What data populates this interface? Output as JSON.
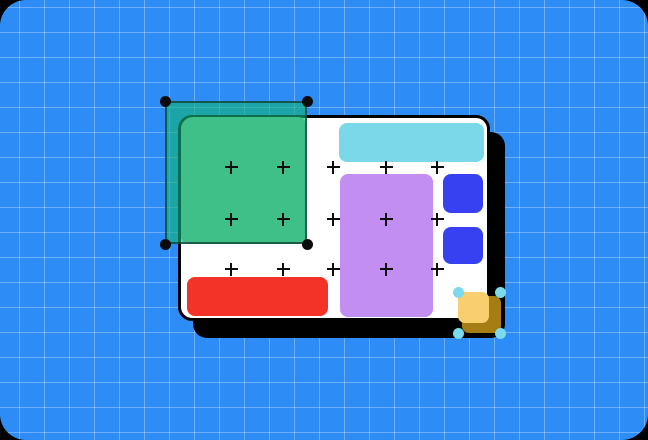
{
  "scene": {
    "outer_background": "#000000",
    "canvas": {
      "background": "#2e8cf6",
      "grid_line_color": "rgba(255,255,255,0.30)",
      "grid_size": 25,
      "grid_offset_x": 19,
      "grid_offset_y": 7,
      "corner_radius": 26
    }
  },
  "artboard": {
    "x": 178,
    "y": 115,
    "w": 312,
    "h": 206,
    "fill": "#ffffff",
    "border_color": "#000000",
    "border_width": 3,
    "radius": 14,
    "shadow_color": "#000000",
    "shadow_dx": 15,
    "shadow_dy": 17
  },
  "shapes": [
    {
      "name": "green-rectangle",
      "fill": "#8ad3a3",
      "x": 181,
      "y": 117,
      "w": 125,
      "h": 127,
      "radius": "12px 8px 8px 8px",
      "layer": 1
    },
    {
      "name": "cyan-bar",
      "fill": "#7ad8e8",
      "x": 339,
      "y": 123,
      "w": 145,
      "h": 39,
      "radius": "8px",
      "layer": 1
    },
    {
      "name": "purple-rectangle",
      "fill": "#c28ef2",
      "x": 340,
      "y": 174,
      "w": 93,
      "h": 143,
      "radius": "8px",
      "layer": 1
    },
    {
      "name": "indigo-square-top",
      "fill": "#3841f1",
      "x": 443,
      "y": 174,
      "w": 40,
      "h": 39,
      "radius": "8px",
      "layer": 1
    },
    {
      "name": "indigo-square-bottom",
      "fill": "#3841f1",
      "x": 443,
      "y": 227,
      "w": 40,
      "h": 37,
      "radius": "8px",
      "layer": 1
    },
    {
      "name": "red-bar",
      "fill": "#f43328",
      "x": 187,
      "y": 277,
      "w": 141,
      "h": 39,
      "radius": "8px",
      "layer": 1
    },
    {
      "name": "yellow-square-shadow",
      "fill": "#a67c15",
      "x": 462,
      "y": 296,
      "w": 39,
      "h": 37,
      "radius": "7px",
      "layer": 5
    },
    {
      "name": "yellow-square",
      "fill": "#f8ce6e",
      "x": 458,
      "y": 292,
      "w": 31,
      "h": 31,
      "radius": "7px",
      "layer": 6
    }
  ],
  "plus_grid": {
    "color": "#0d0d0d",
    "size": 13,
    "thickness": 2,
    "cols": [
      231,
      283,
      333,
      386,
      437
    ],
    "rows": [
      167,
      219,
      269
    ]
  },
  "marquee": {
    "x": 165,
    "y": 101,
    "w": 142,
    "h": 143,
    "fill": "rgba(18,180,120,0.62)",
    "stroke": "rgba(15,60,50,0.75)",
    "stroke_width": 2,
    "handle_color": "#0b0b0b",
    "handle_diameter": 11
  },
  "mini_selection": {
    "x": 458,
    "y": 292,
    "w": 42,
    "h": 41,
    "handle_color": "#7bdbec",
    "handle_diameter": 11
  }
}
